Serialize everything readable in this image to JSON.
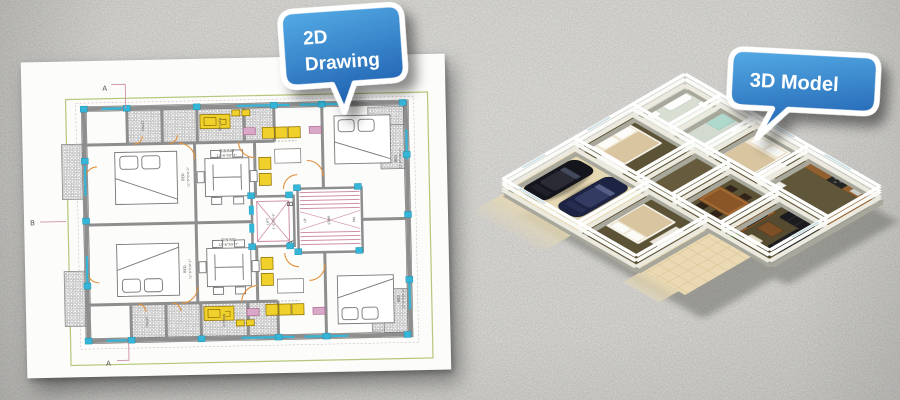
{
  "scene": {
    "background_color": "#c7c6c2",
    "paper_color": "#fcfcfa"
  },
  "bubbles": {
    "left": {
      "line1": "2D",
      "line2": "Drawing",
      "color_top": "#55ace6",
      "color_bottom": "#1f61b0"
    },
    "right": {
      "label": "3D Model",
      "color_top": "#55ace6",
      "color_bottom": "#1f61b0"
    }
  },
  "plan_2d": {
    "labels": {
      "dining_name": "DINING",
      "dining_dims": "12'-6\"X9'-7\"",
      "bed_name": "BED",
      "bed_dims": "12'-6\"X10'-2\"",
      "lift_name": "LIFT",
      "lift_dims": "4'-6\"X4'-6\"",
      "stair_name": "STAIR",
      "up": "UP",
      "dn": "DN",
      "kitchen_name": "KITCHEN",
      "toilet_name": "TOILET",
      "section_a": "A",
      "section_b": "B"
    },
    "colors": {
      "frame": "#b4c77c",
      "columns": "#35b6d9",
      "stair_pink": "#cf8fa8",
      "door_orange": "#e2913d",
      "fixture_yellow": "#f0d02a",
      "wall_gray": "#8e8e8e"
    }
  },
  "model_3d": {
    "colors": {
      "wall": "#ffffff",
      "floor_olive": "#5c5336",
      "floor_cream": "#e6d8b2",
      "wood": "#8a5a2e",
      "sofa_black": "#1b1b1f",
      "car_navy": "#1d2342",
      "car_black": "#15151d",
      "plant_green": "#4e7b33"
    }
  }
}
